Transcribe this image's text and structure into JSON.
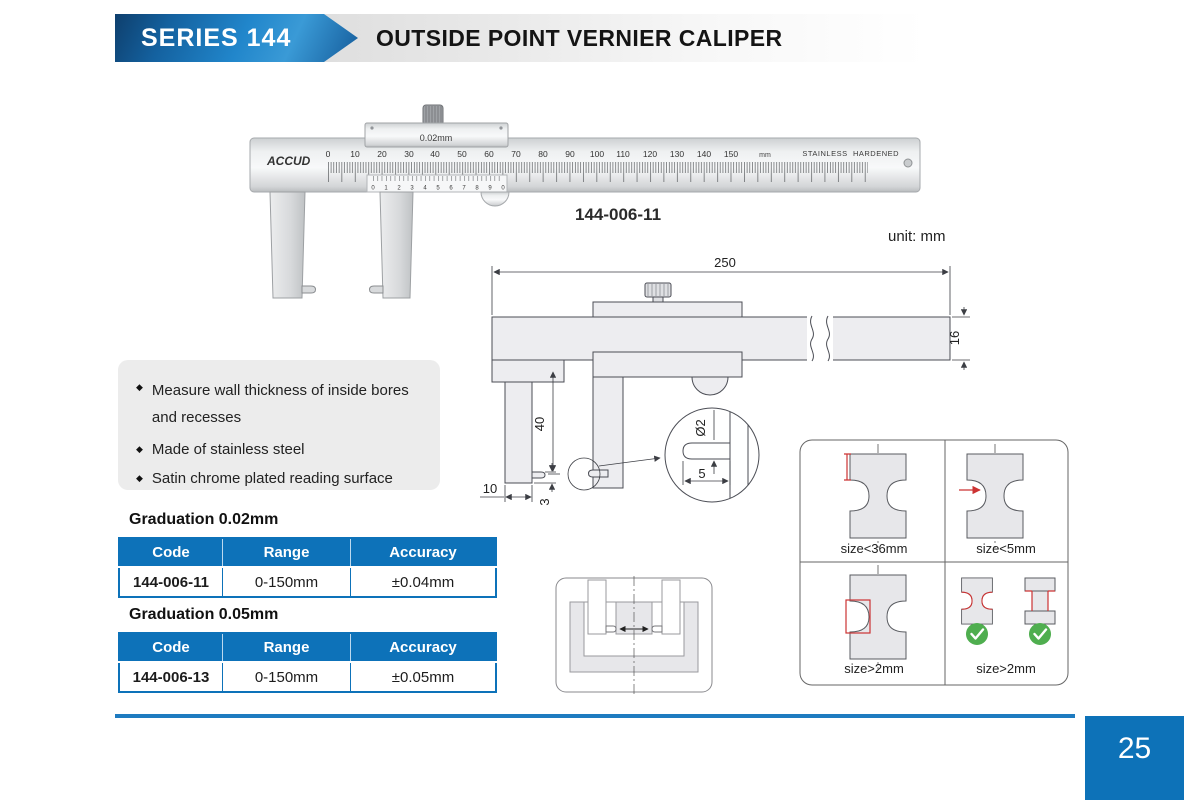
{
  "header": {
    "series": "SERIES 144",
    "title": "OUTSIDE POINT VERNIER CALIPER"
  },
  "photo": {
    "brand": "ACCUD",
    "slider_graduation": "0.02mm",
    "scale_numbers": [
      "0",
      "10",
      "20",
      "30",
      "40",
      "50",
      "60",
      "70",
      "80",
      "90",
      "100",
      "110",
      "120",
      "130",
      "140",
      "150"
    ],
    "unit": "mm",
    "stainless": "STAINLESS",
    "hardened": "HARDENED",
    "vernier_numbers": [
      "0",
      "1",
      "2",
      "3",
      "4",
      "5",
      "6",
      "7",
      "8",
      "9",
      "0"
    ],
    "model": "144-006-11"
  },
  "unit_note": "unit: mm",
  "drawing": {
    "overall_length": "250",
    "beam_height": "16",
    "jaw_depth": "40",
    "jaw_width": "10",
    "point_height": "3",
    "point_diameter": "Ø2",
    "point_length": "5"
  },
  "glyphs": {
    "bullet": "◆"
  },
  "features": [
    "Measure wall thickness of inside bores and recesses",
    "Made of stainless steel",
    "Satin chrome plated reading surface"
  ],
  "spec_tables": [
    {
      "heading": "Graduation 0.02mm",
      "columns": [
        "Code",
        "Range",
        "Accuracy"
      ],
      "rows": [
        [
          "144-006-11",
          "0-150mm",
          "±0.04mm"
        ]
      ]
    },
    {
      "heading": "Graduation 0.05mm",
      "columns": [
        "Code",
        "Range",
        "Accuracy"
      ],
      "rows": [
        [
          "144-006-13",
          "0-150mm",
          "±0.05mm"
        ]
      ]
    }
  ],
  "size_panel": {
    "labels": [
      "size<36mm",
      "size<5mm",
      "size>2mm",
      "size>2mm"
    ]
  },
  "page_number": "25",
  "colors": {
    "accent_blue": "#0d72b9",
    "check_green": "#4fae4f",
    "dim_red": "#cc3333"
  }
}
